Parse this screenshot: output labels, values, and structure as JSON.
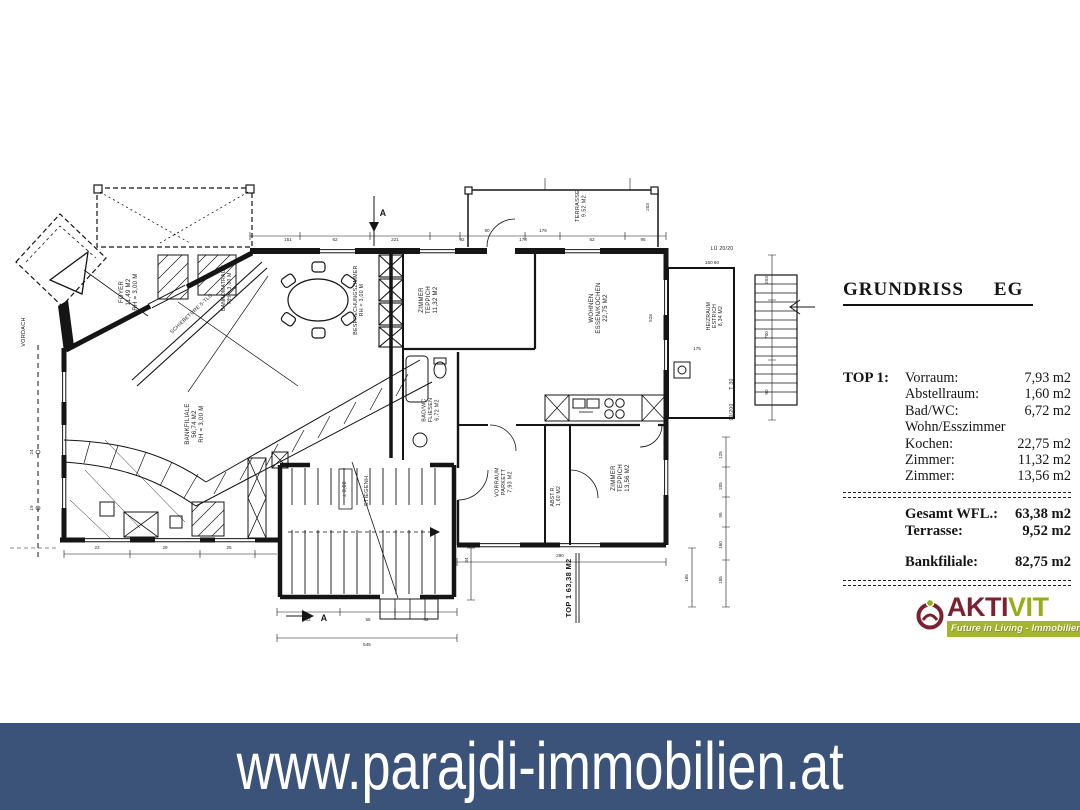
{
  "panel": {
    "title_word1": "GRUNDRISS",
    "title_word2": "EG",
    "top1_label": "TOP 1:",
    "rooms": [
      {
        "name": "Vorraum:",
        "value": "7,93 m2"
      },
      {
        "name": "Abstellraum:",
        "value": "1,60 m2"
      },
      {
        "name": "Bad/WC:",
        "value": "6,72 m2"
      },
      {
        "name": "Wohn/Esszimmer",
        "value": ""
      },
      {
        "name": "Kochen:",
        "value": "22,75 m2"
      },
      {
        "name": "Zimmer:",
        "value": "11,32 m2"
      },
      {
        "name": "Zimmer:",
        "value": "13,56 m2"
      }
    ],
    "totals": [
      {
        "name": "Gesamt WFL.:",
        "value": "63,38 m2"
      },
      {
        "name": "Terrasse:",
        "value": "9,52 m2"
      }
    ],
    "bank": {
      "name": "Bankfiliale:",
      "value": "82,75 m2"
    }
  },
  "logo": {
    "brand_part1": "AKTI",
    "brand_part2": "VIT",
    "tagline": "Future in Living - Immobilien.",
    "colors": {
      "maroon": "#7b2130",
      "green": "#96ad17",
      "banner_green": "#a4b52e"
    }
  },
  "footer": {
    "url": "www.parajdi-immobilien.at",
    "bg": "#3b5379",
    "fg": "#ffffff"
  },
  "plan": {
    "labels": [
      {
        "n": "label-foyer",
        "t": [
          "FOYER",
          "11,49 M2",
          "RH = 3,00 M"
        ],
        "x": 130,
        "y": 292,
        "r": -90,
        "s": 6
      },
      {
        "n": "label-vordach",
        "t": [
          "VORDACH"
        ],
        "x": 25,
        "y": 332,
        "r": -90,
        "s": 5.5
      },
      {
        "n": "label-schiebetuere",
        "t": [
          "SCHIEBETÜRE 5-TLG."
        ],
        "x": 193,
        "y": 314,
        "r": -43,
        "s": 5
      },
      {
        "n": "label-bankomatraum",
        "t": [
          "BANKOMATRAUM",
          "RH = 3,00 M"
        ],
        "x": 228,
        "y": 288,
        "r": -90,
        "s": 5
      },
      {
        "n": "label-besprechungszimmer",
        "t": [
          "BESPRECHUNGSZIMMER",
          "RH = 3,00 M"
        ],
        "x": 360,
        "y": 300,
        "r": -90,
        "s": 5.2
      },
      {
        "n": "label-bankfiliale",
        "t": [
          "BANKFILIALE",
          "56,74 M2",
          "RH = 3,00 M"
        ],
        "x": 196,
        "y": 424,
        "r": -90,
        "s": 6
      },
      {
        "n": "label-zimmer-1",
        "t": [
          "ZIMMER",
          "TEPPICH",
          "11,32 M2"
        ],
        "x": 430,
        "y": 300,
        "r": -90,
        "s": 6
      },
      {
        "n": "label-wohnen",
        "t": [
          "WOHNEN",
          "ESSEN/KOCHEN",
          "22,75 M2"
        ],
        "x": 600,
        "y": 308,
        "r": -90,
        "s": 6
      },
      {
        "n": "label-bad-wc",
        "t": [
          "BAD/WC",
          "FLIESEN",
          "6,72 M2"
        ],
        "x": 432,
        "y": 410,
        "r": -90,
        "s": 5.4
      },
      {
        "n": "label-vorraum",
        "t": [
          "VORRAUM",
          "PARKETT",
          "7,93 M2"
        ],
        "x": 505,
        "y": 482,
        "r": -90,
        "s": 5.4
      },
      {
        "n": "label-abstellraum",
        "t": [
          "ABST.R.",
          "1,60 M2"
        ],
        "x": 557,
        "y": 496,
        "r": -90,
        "s": 5
      },
      {
        "n": "label-zimmer-2",
        "t": [
          "ZIMMER",
          "TEPPICH",
          "13,56 M2"
        ],
        "x": 622,
        "y": 478,
        "r": -90,
        "s": 6
      },
      {
        "n": "label-stiegenhaus",
        "t": [
          "STIEGENH."
        ],
        "x": 368,
        "y": 490,
        "r": -90,
        "s": 5.5
      },
      {
        "n": "label-level",
        "t": [
          "± 0,00"
        ],
        "x": 346,
        "y": 489,
        "r": -90,
        "s": 5
      },
      {
        "n": "label-terrasse",
        "t": [
          "TERRASSE",
          "9,52 M2"
        ],
        "x": 582,
        "y": 206,
        "r": -90,
        "s": 5.5
      },
      {
        "n": "label-heizraum",
        "t": [
          "HEIZRAUM",
          "ESTRICH",
          "8,34 M2"
        ],
        "x": 716,
        "y": 316,
        "r": -90,
        "s": 5
      },
      {
        "n": "label-lueftung",
        "t": [
          "LÜ 20/20"
        ],
        "x": 722,
        "y": 250,
        "r": 0,
        "s": 5
      },
      {
        "n": "label-top1-area",
        "t": [
          "TOP 1   63,38 M2"
        ],
        "x": 571,
        "y": 588,
        "r": -90,
        "s": 7.5,
        "b": true
      },
      {
        "n": "label-door-t30",
        "t": [
          "T 30"
        ],
        "x": 733,
        "y": 384,
        "r": -90,
        "s": 5
      },
      {
        "n": "label-door-size",
        "t": [
          "90/200"
        ],
        "x": 733,
        "y": 412,
        "r": -90,
        "s": 5
      },
      {
        "n": "section-a-top",
        "t": [
          "A"
        ],
        "x": 383,
        "y": 216,
        "r": 0,
        "s": 9,
        "b": true
      },
      {
        "n": "section-a-bottom",
        "t": [
          "A"
        ],
        "x": 324,
        "y": 621,
        "r": 0,
        "s": 9,
        "b": true
      }
    ],
    "dims": [
      {
        "t": [
          "151"
        ],
        "x": 288,
        "y": 241
      },
      {
        "t": [
          "62"
        ],
        "x": 335,
        "y": 241
      },
      {
        "t": [
          "221"
        ],
        "x": 395,
        "y": 241
      },
      {
        "t": [
          "92"
        ],
        "x": 462,
        "y": 241
      },
      {
        "t": [
          "178"
        ],
        "x": 523,
        "y": 241
      },
      {
        "t": [
          "62"
        ],
        "x": 592,
        "y": 241
      },
      {
        "t": [
          "95"
        ],
        "x": 643,
        "y": 241
      },
      {
        "t": [
          "90"
        ],
        "x": 487,
        "y": 232
      },
      {
        "t": [
          "176"
        ],
        "x": 543,
        "y": 232
      },
      {
        "t": [
          "203"
        ],
        "x": 649,
        "y": 207,
        "r": -90
      },
      {
        "t": [
          "203"
        ],
        "x": 768,
        "y": 280,
        "r": -90
      },
      {
        "t": [
          "700"
        ],
        "x": 768,
        "y": 335,
        "r": -90
      },
      {
        "t": [
          "90"
        ],
        "x": 768,
        "y": 392,
        "r": -90
      },
      {
        "t": [
          "160  60"
        ],
        "x": 712,
        "y": 264
      },
      {
        "t": [
          "175"
        ],
        "x": 697,
        "y": 350
      },
      {
        "t": [
          "125"
        ],
        "x": 722,
        "y": 455,
        "r": -90
      },
      {
        "t": [
          "205"
        ],
        "x": 722,
        "y": 486,
        "r": -90
      },
      {
        "t": [
          "95"
        ],
        "x": 722,
        "y": 515,
        "r": -90
      },
      {
        "t": [
          "160"
        ],
        "x": 722,
        "y": 545,
        "r": -90
      },
      {
        "t": [
          "185"
        ],
        "x": 722,
        "y": 580,
        "r": -90
      },
      {
        "t": [
          "528"
        ],
        "x": 652,
        "y": 318,
        "r": -90
      },
      {
        "t": [
          "34"
        ],
        "x": 468,
        "y": 560,
        "r": -90
      },
      {
        "t": [
          "165"
        ],
        "x": 688,
        "y": 578,
        "r": -90
      },
      {
        "t": [
          "290"
        ],
        "x": 560,
        "y": 557
      },
      {
        "t": [
          "23"
        ],
        "x": 97,
        "y": 549
      },
      {
        "t": [
          "29"
        ],
        "x": 165,
        "y": 549
      },
      {
        "t": [
          "25"
        ],
        "x": 229,
        "y": 549
      },
      {
        "t": [
          "63"
        ],
        "x": 308,
        "y": 621
      },
      {
        "t": [
          "55"
        ],
        "x": 368,
        "y": 621
      },
      {
        "t": [
          "62"
        ],
        "x": 426,
        "y": 621
      },
      {
        "t": [
          "545"
        ],
        "x": 367,
        "y": 646
      },
      {
        "t": [
          "24"
        ],
        "x": 33,
        "y": 452,
        "r": -90
      },
      {
        "t": [
          "19"
        ],
        "x": 33,
        "y": 508,
        "r": -90
      }
    ]
  }
}
